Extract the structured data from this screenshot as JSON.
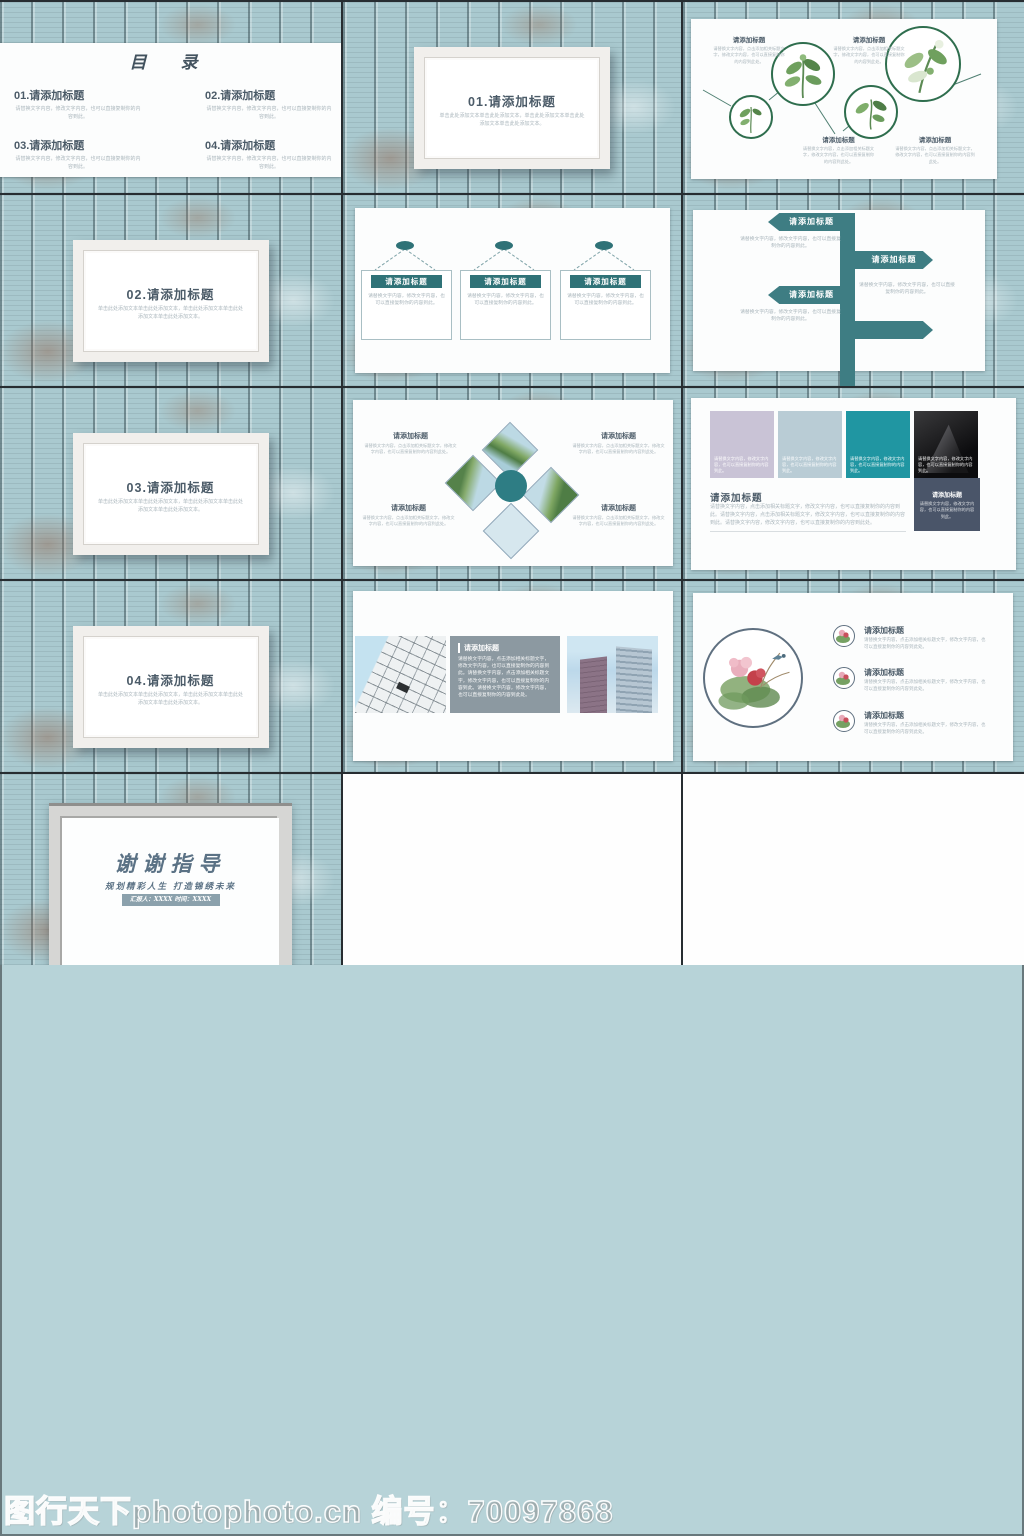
{
  "common": {
    "item_title": "请添加标题",
    "filler_short": "请替换文字内容，修改文字内容，也可以直接复制你的内容到此。",
    "filler_med": "请替换文字内容，点击添加相关标题文字，修改文字内容，也可以直接复制你的内容到此处。",
    "filler_long": "请替换文字内容，点击添加相关标题文字，修改文字内容，也可以直接复制你的内容到此。请替换文字内容，点击添加相关标题文字，修改文字内容，也可以直接复制你的内容到此。请替换文字内容，修改文字内容，也可以直接复制你的内容到此处。",
    "divider_note": "单击此处添加文本单击此处添加文本，单击此处添加文本单击此处添加文本单击此处添加文本。"
  },
  "hero": {
    "title": "职业生涯规划",
    "subtitle": "规划精彩人生 打造锦绣未来",
    "presenter_bar": "汇报人：XXXX  时间：XXXX"
  },
  "toc": {
    "title": "目 录",
    "items": [
      {
        "title": "01.请添加标题"
      },
      {
        "title": "02.请添加标题"
      },
      {
        "title": "03.请添加标题"
      },
      {
        "title": "04.请添加标题"
      }
    ]
  },
  "dividers": {
    "d1": "01.请添加标题",
    "d2": "02.请添加标题",
    "d3": "03.请添加标题",
    "d4": "04.请添加标题"
  },
  "thanks": {
    "title": "谢谢指导",
    "subtitle": "规划精彩人生 打造锦绣未来",
    "presenter_bar": "汇报人：XXXX  时间：XXXX"
  },
  "watermark": "图行天下photophoto.cn 编号：70097868",
  "colors": {
    "accent_teal": "#3e7d83",
    "teal_bright": "#2096a2",
    "lavender": "#c9c3d6",
    "pale_blue": "#b9ccd5",
    "dark_slate": "#4a5569",
    "title_blue": "#5b7285",
    "bar_gray": "#8ba1ac",
    "wood_base": "#aecdd3",
    "plant_green": "#2f6e4e"
  }
}
